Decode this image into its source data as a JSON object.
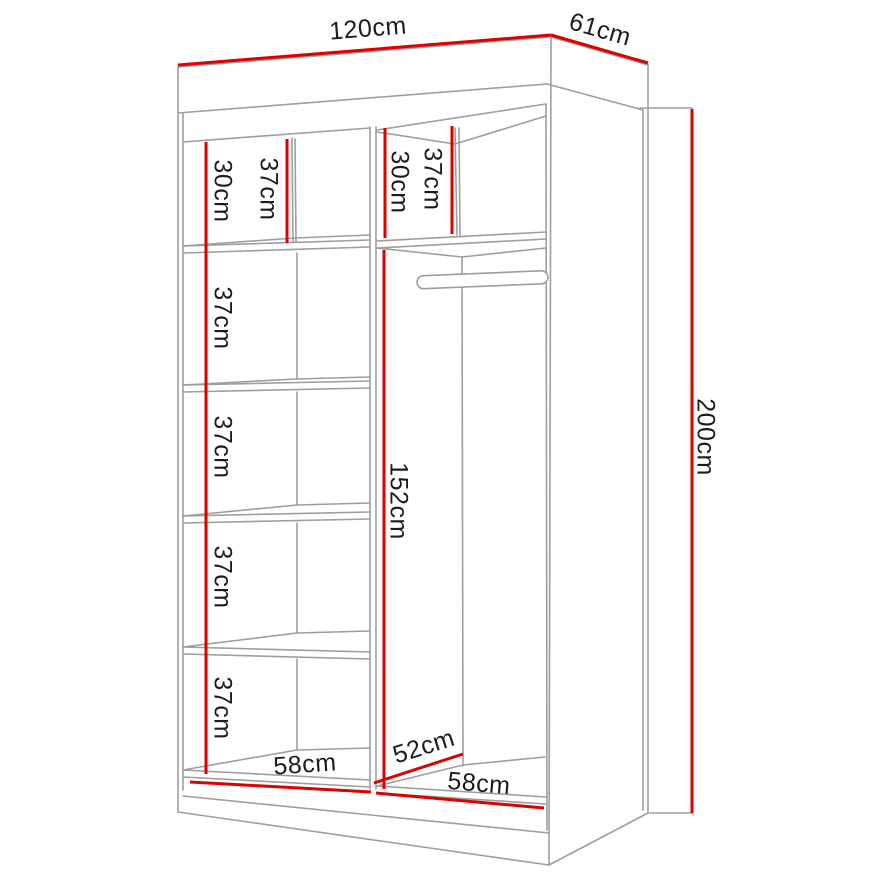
{
  "colors": {
    "dimension": "#dd0000",
    "outline": "#9e9e9e",
    "text": "#1c1c1c",
    "background": "#ffffff"
  },
  "dimensions": {
    "overall": {
      "width": "120cm",
      "depth": "61cm",
      "height": "200cm"
    },
    "left_column": {
      "top_shelf_back_height": "30cm",
      "top_shelf_front_height": "37cm",
      "shelf_spacings": [
        "37cm",
        "37cm",
        "37cm",
        "37cm"
      ],
      "interior_width": "58cm"
    },
    "right_column": {
      "top_shelf_back_height": "30cm",
      "top_shelf_front_height": "37cm",
      "hanging_space_height": "152cm",
      "interior_depth": "52cm",
      "interior_width": "58cm"
    }
  }
}
